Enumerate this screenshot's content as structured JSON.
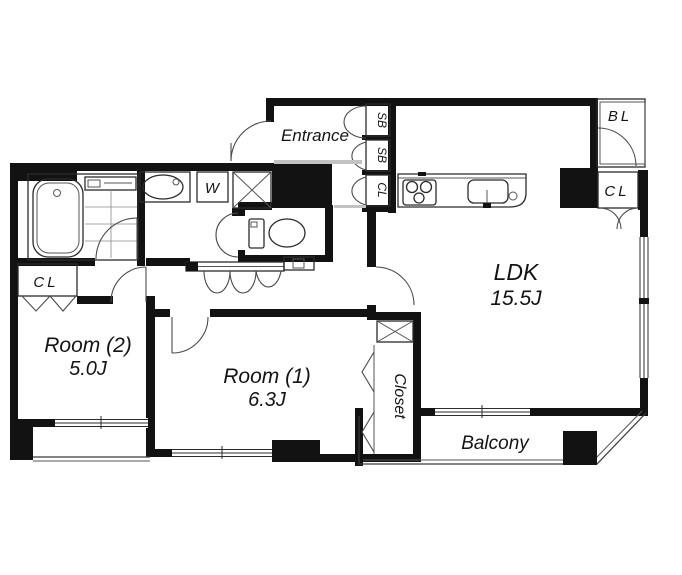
{
  "plan_title": "apartment-floor-plan",
  "labels": {
    "entrance": "Entrance",
    "ldk_name": "LDK",
    "ldk_size": "15.5J",
    "room1_name": "Room (1)",
    "room1_size": "6.3J",
    "room2_name": "Room (2)",
    "room2_size": "5.0J",
    "closet": "Closet",
    "balcony": "Balcony",
    "upper_balcony": "BL",
    "ldk_closet": "CL",
    "room2_closet": "CL",
    "hall_storage_top": "SB",
    "hall_storage_mid": "SB",
    "hall_storage_bottom": "CL",
    "washing_machine": "W"
  },
  "colors": {
    "wall": "#121212",
    "background": "#ffffff",
    "line": "#2b2b2b"
  }
}
